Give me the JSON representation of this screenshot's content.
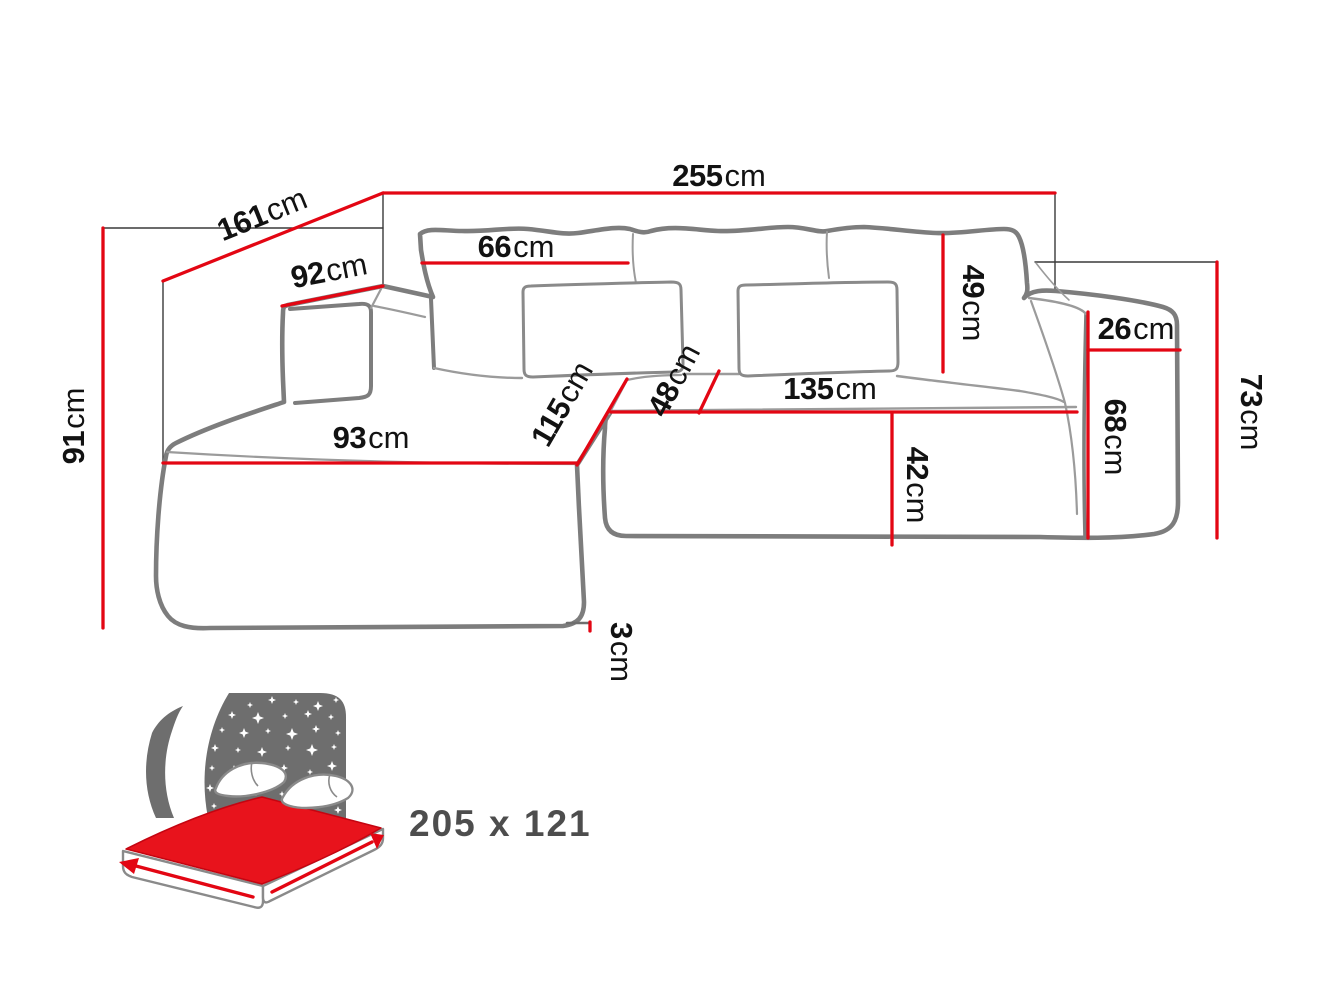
{
  "diagram_type": "corner-sofa-dimension-diagram",
  "colors": {
    "dimension_red": "#e30613",
    "mattress_red": "#e8131c",
    "outline_gray": "#7d7d7d",
    "detail_gray": "#9b9b9b",
    "extension_black": "#3a3a3a",
    "text_black": "#121212",
    "icon_gray": "#6e6e6e",
    "bed_size_gray": "#4d4d4d"
  },
  "dimensions": {
    "total_width": {
      "value": "255",
      "unit": "cm"
    },
    "total_depth": {
      "value": "161",
      "unit": "cm"
    },
    "armrest_left_top": {
      "value": "92",
      "unit": "cm"
    },
    "side_height_left": {
      "value": "91",
      "unit": "cm"
    },
    "back_cushion_width": {
      "value": "66",
      "unit": "cm"
    },
    "back_cushion_height": {
      "value": "49",
      "unit": "cm"
    },
    "armrest_right_width": {
      "value": "26",
      "unit": "cm"
    },
    "armrest_right_height": {
      "value": "68",
      "unit": "cm"
    },
    "total_height": {
      "value": "73",
      "unit": "cm"
    },
    "seat_front_width": {
      "value": "135",
      "unit": "cm"
    },
    "seat_front_height": {
      "value": "42",
      "unit": "cm"
    },
    "front_pillow": {
      "value": "48",
      "unit": "cm"
    },
    "chaise_depth": {
      "value": "115",
      "unit": "cm"
    },
    "chaise_front_width": {
      "value": "93",
      "unit": "cm"
    },
    "leg_height": {
      "value": "3",
      "unit": "cm"
    }
  },
  "sleeping_area": {
    "icon": "bed-with-starry-night-icon",
    "label": "205 x 121"
  }
}
